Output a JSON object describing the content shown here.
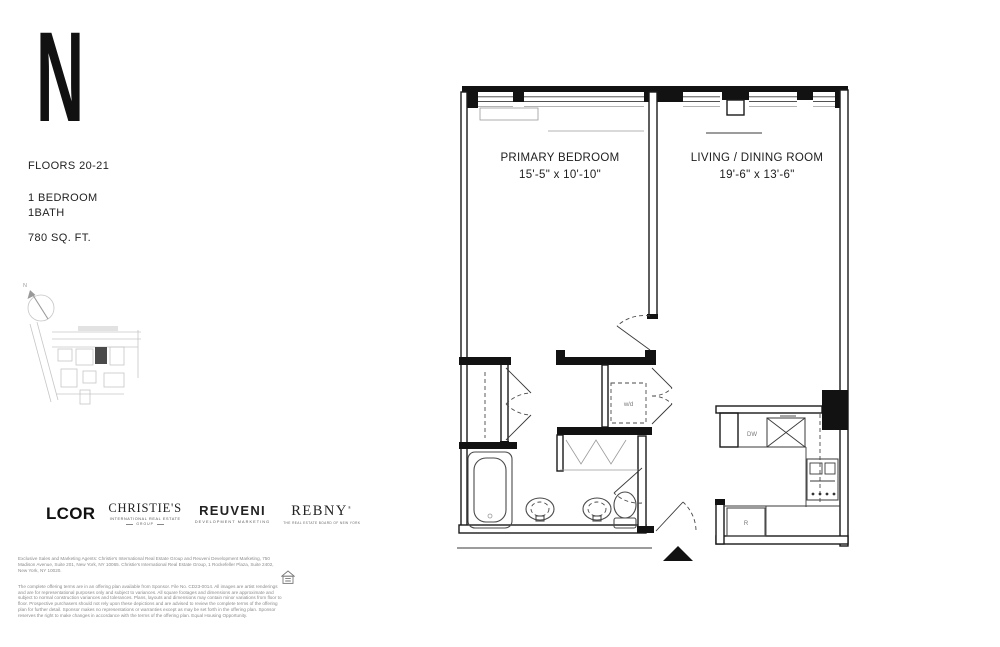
{
  "sidebar": {
    "logo_letter": "N",
    "floors": "FLOORS 20-21",
    "bedrooms": "1 BEDROOM",
    "baths": "1BATH",
    "area": "780 SQ. FT.",
    "compass_n": "N"
  },
  "plan": {
    "rooms": [
      {
        "label": "PRIMARY BEDROOM",
        "dims": "15'-5\" x 10'-10\""
      },
      {
        "label": "LIVING / DINING ROOM",
        "dims": "19'-6\" x 13'-6\""
      }
    ],
    "labels": {
      "washer_dryer": "w/d",
      "dishwasher": "DW",
      "fridge": "R"
    }
  },
  "logos": {
    "lcor": {
      "text": "LCOR"
    },
    "christies": {
      "main": "CHRISTIE'S",
      "sub1": "INTERNATIONAL REAL ESTATE",
      "sub2": "GROUP"
    },
    "reuveni": {
      "main": "REUVENI",
      "sub": "DEVELOPMENT MARKETING"
    },
    "rebny": {
      "main": "REBNY",
      "mark": "®",
      "sub": "THE REAL ESTATE BOARD OF NEW YORK"
    }
  },
  "disclaimer": {
    "p1": "Exclusive Sales and Marketing Agents: Christie's International Real Estate Group and Reuveni Development Marketing, 750 Madison Avenue, Suite 201, New York, NY 10065. Christie's International Real Estate Group, 1 Rockefeller Plaza, Suite 2402, New York, NY 10020.",
    "p2": "The complete offering terms are in an offering plan available from Sponsor. File No. CD23-0014. All images are artist renderings and are for representational purposes only and subject to variances. All square footages and dimensions are approximate and subject to normal construction variances and tolerances. Plans, layouts and dimensions may contain minor variations from floor to floor. Prospective purchasers should not rely upon these depictions and are advised to review the complete terms of the offering plan for further detail. Sponsor makes no representations or warranties except as may be set forth in the offering plan. Sponsor reserves the right to make changes in accordance with the terms of the offering plan. Equal Housing Opportunity."
  },
  "colors": {
    "line": "#1a1a1a",
    "muted_line": "#c6c6c6",
    "text": "#1d1d1d",
    "disclaimer_text": "#8b8b8b",
    "keyplan_marker": "#4a4a4a"
  }
}
